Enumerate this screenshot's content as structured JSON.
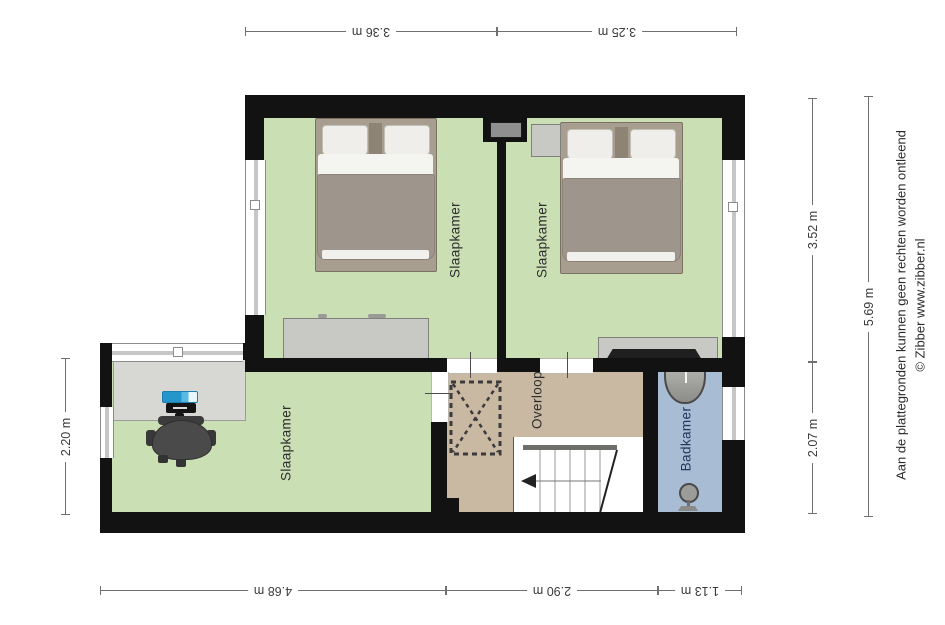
{
  "rooms": {
    "bedroom_top_left": {
      "label": "Slaapkamer"
    },
    "bedroom_top_right": {
      "label": "Slaapkamer"
    },
    "bedroom_bottom_left": {
      "label": "Slaapkamer"
    },
    "landing": {
      "label": "Overloop"
    },
    "bathroom": {
      "label": "Badkamer"
    }
  },
  "dimensions": {
    "top": [
      {
        "label": "3.36 m"
      },
      {
        "label": "3.25 m"
      }
    ],
    "bottom": [
      {
        "label": "4.68 m"
      },
      {
        "label": "2.90 m"
      },
      {
        "label": "1.13 m"
      }
    ],
    "left": [
      {
        "label": "2.20 m"
      }
    ],
    "right_inner": [
      {
        "label": "3.52 m"
      },
      {
        "label": "2.07 m"
      }
    ],
    "right_outer": [
      {
        "label": "5.69 m"
      }
    ]
  },
  "disclaimer": {
    "line1": "Aan de plattegronden kunnen geen rechten worden ontleend",
    "line2": "© Zibber www.zibber.nl"
  },
  "colors": {
    "wall": "#121212",
    "bedroom_floor": "#cbdfb5",
    "landing_floor": "#c9b8a2",
    "bathroom_floor": "#a8bcd3",
    "bathroom_label": "#24365c",
    "duvet_gray": "#9e968c",
    "monitor_blue": "#2496cc",
    "dimension_line": "#6f6f6f"
  }
}
